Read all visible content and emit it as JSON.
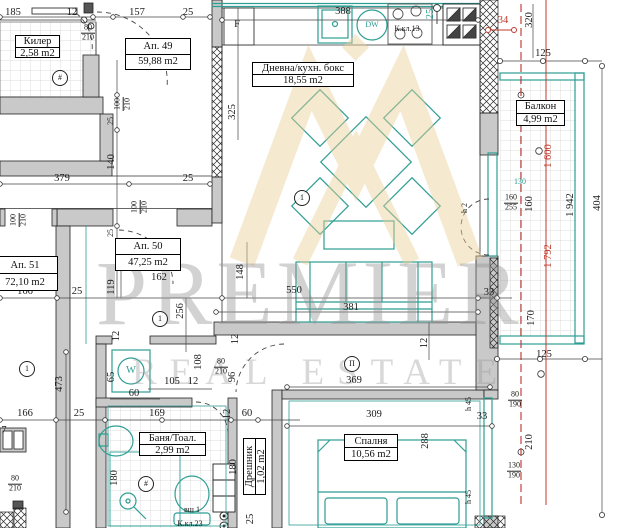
{
  "watermark": {
    "line1": "PREMIER",
    "line2": "REAL ESTATE"
  },
  "colors": {
    "teal": "#2e9e93",
    "red": "#c0392b",
    "wall_gray": "#c9c9c9",
    "watermark_gold": "#e9cf96",
    "watermark_gray": "#949494"
  },
  "rooms": [
    {
      "name": "Килер",
      "area": "2,58 m2",
      "x": 15,
      "y": 35,
      "w": 45,
      "h": 23
    },
    {
      "name": "Ап. 49",
      "area": "59,88 m2",
      "x": 125,
      "y": 38,
      "w": 66,
      "h": 32
    },
    {
      "name": "Дневна/кухн. бокс",
      "area": "18,55 m2",
      "x": 252,
      "y": 62,
      "w": 102,
      "h": 25
    },
    {
      "name": "Ап. 50",
      "area": "47,25 m2",
      "x": 115,
      "y": 238,
      "w": 66,
      "h": 33
    },
    {
      "name": "Ап. 51",
      "area": "72,10 m2",
      "x": -8,
      "y": 256,
      "w": 66,
      "h": 35
    },
    {
      "name": "Балкон",
      "area": "4,99 m2",
      "x": 516,
      "y": 100,
      "w": 49,
      "h": 26
    },
    {
      "name": "Баня/Тоал.",
      "area": "2,99 m2",
      "x": 139,
      "y": 432,
      "w": 67,
      "h": 24
    },
    {
      "name": "Спалня",
      "area": "10,56 m2",
      "x": 344,
      "y": 434,
      "w": 54,
      "h": 27
    },
    {
      "name": "Дрешник",
      "area": "1,02 m2",
      "x": 226,
      "y": 455,
      "w": 57,
      "h": 23,
      "vertical": true
    }
  ],
  "labels": [
    {
      "t": "185",
      "x": 13,
      "y": 13
    },
    {
      "t": "12",
      "x": 72,
      "y": 13
    },
    {
      "t": "157",
      "x": 137,
      "y": 13
    },
    {
      "t": "25",
      "x": 188,
      "y": 13
    },
    {
      "t": "388",
      "x": 343,
      "y": 12
    },
    {
      "t": "25",
      "x": 431,
      "y": 14,
      "v": 1,
      "teal": 1
    },
    {
      "t": "К.кл.13",
      "x": 407,
      "y": 29,
      "small": 1
    },
    {
      "t": "34",
      "x": 503,
      "y": 21,
      "red": 1
    },
    {
      "t": "320",
      "x": 530,
      "y": 20,
      "v": 1
    },
    {
      "t": "125",
      "x": 543,
      "y": 54
    },
    {
      "pair": [
        "80",
        "210"
      ],
      "x": 88,
      "y": 33
    },
    {
      "pair": [
        "100",
        "210"
      ],
      "x": 123,
      "y": 104,
      "v": 1
    },
    {
      "t": "25",
      "x": 111,
      "y": 121,
      "v": 1,
      "small": 1
    },
    {
      "t": "140",
      "x": 112,
      "y": 162,
      "v": 1
    },
    {
      "t": "325",
      "x": 233,
      "y": 112,
      "v": 1
    },
    {
      "t": "379",
      "x": 62,
      "y": 179
    },
    {
      "t": "25",
      "x": 188,
      "y": 179
    },
    {
      "pair": [
        "100",
        "210"
      ],
      "x": 19,
      "y": 220,
      "v": 1
    },
    {
      "pair": [
        "100",
        "210"
      ],
      "x": 140,
      "y": 207,
      "v": 1
    },
    {
      "t": "25",
      "x": 111,
      "y": 233,
      "v": 1,
      "small": 1
    },
    {
      "t": "162",
      "x": 159,
      "y": 278
    },
    {
      "t": "119",
      "x": 112,
      "y": 287,
      "v": 1
    },
    {
      "t": "148",
      "x": 241,
      "y": 272,
      "v": 1
    },
    {
      "t": "256",
      "x": 181,
      "y": 311,
      "v": 1
    },
    {
      "t": "550",
      "x": 294,
      "y": 291
    },
    {
      "t": "381",
      "x": 351,
      "y": 308
    },
    {
      "t": "166",
      "x": 25,
      "y": 292
    },
    {
      "t": "25",
      "x": 77,
      "y": 292
    },
    {
      "t": "33",
      "x": 489,
      "y": 293
    },
    {
      "t": "12",
      "x": 236,
      "y": 339,
      "v": 1
    },
    {
      "t": "12",
      "x": 425,
      "y": 343,
      "v": 1
    },
    {
      "t": "473",
      "x": 60,
      "y": 384,
      "v": 1
    },
    {
      "t": "65",
      "x": 112,
      "y": 377,
      "v": 1
    },
    {
      "t": "60",
      "x": 134,
      "y": 394
    },
    {
      "t": "12",
      "x": 117,
      "y": 336,
      "v": 1
    },
    {
      "t": "105",
      "x": 172,
      "y": 382
    },
    {
      "t": "12",
      "x": 193,
      "y": 382
    },
    {
      "t": "108",
      "x": 199,
      "y": 362,
      "v": 1
    },
    {
      "pair": [
        "80",
        "210"
      ],
      "x": 221,
      "y": 367,
      "small": 1
    },
    {
      "t": "96",
      "x": 233,
      "y": 377,
      "v": 1
    },
    {
      "t": "166",
      "x": 25,
      "y": 414
    },
    {
      "t": "25",
      "x": 79,
      "y": 414
    },
    {
      "t": "169",
      "x": 157,
      "y": 414
    },
    {
      "t": "12",
      "x": 228,
      "y": 414,
      "v": 1
    },
    {
      "t": "60",
      "x": 247,
      "y": 414
    },
    {
      "t": "180",
      "x": 115,
      "y": 478,
      "v": 1
    },
    {
      "t": "180",
      "x": 234,
      "y": 467,
      "v": 1
    },
    {
      "t": "7",
      "x": 4,
      "y": 431
    },
    {
      "pair": [
        "80",
        "210"
      ],
      "x": 15,
      "y": 484,
      "small": 1
    },
    {
      "t": "вш 1",
      "x": 192,
      "y": 510,
      "small": 1
    },
    {
      "t": "К.кл.23",
      "x": 190,
      "y": 524,
      "small": 1
    },
    {
      "t": "25",
      "x": 251,
      "y": 519,
      "v": 1
    },
    {
      "t": "369",
      "x": 354,
      "y": 381
    },
    {
      "t": "309",
      "x": 374,
      "y": 415
    },
    {
      "t": "288",
      "x": 426,
      "y": 441,
      "v": 1
    },
    {
      "t": "h 45",
      "x": 469,
      "y": 404,
      "v": 1,
      "small": 1
    },
    {
      "t": "h 45",
      "x": 469,
      "y": 497,
      "v": 1,
      "small": 1
    },
    {
      "t": "33",
      "x": 482,
      "y": 417
    },
    {
      "pair": [
        "80",
        "190"
      ],
      "x": 515,
      "y": 400,
      "small": 1
    },
    {
      "pair": [
        "130",
        "190"
      ],
      "x": 514,
      "y": 471,
      "small": 1
    },
    {
      "t": "210",
      "x": 530,
      "y": 442,
      "v": 1
    },
    {
      "t": "125",
      "x": 544,
      "y": 355
    },
    {
      "t": "170",
      "x": 532,
      "y": 318,
      "v": 1
    },
    {
      "t": "130",
      "x": 520,
      "y": 182,
      "teal": 1,
      "small": 1
    },
    {
      "pair": [
        "160",
        "255"
      ],
      "x": 511,
      "y": 203,
      "small": 1
    },
    {
      "t": "160",
      "x": 530,
      "y": 204,
      "v": 1
    },
    {
      "t": "h 2",
      "x": 465,
      "y": 208,
      "v": 1,
      "small": 1
    },
    {
      "t": "1 942",
      "x": 571,
      "y": 205,
      "v": 1
    },
    {
      "t": "404",
      "x": 598,
      "y": 203,
      "v": 1
    },
    {
      "t": "1 600",
      "x": 549,
      "y": 156,
      "v": 1,
      "red": 1
    },
    {
      "t": "1 792",
      "x": 549,
      "y": 256,
      "v": 1,
      "red": 1
    },
    {
      "t": "F",
      "x": 237,
      "y": 25
    },
    {
      "t": "DW",
      "x": 372,
      "y": 25,
      "teal": 1,
      "small": 1
    },
    {
      "t": "W",
      "x": 131,
      "y": 371,
      "teal": 1
    },
    {
      "t": "1",
      "x": 302,
      "y": 198,
      "circled": 1
    },
    {
      "t": "1",
      "x": 160,
      "y": 319,
      "circled": 1
    },
    {
      "t": "1",
      "x": 27,
      "y": 369,
      "circled": 1
    },
    {
      "t": "П",
      "x": 352,
      "y": 364,
      "circled": 1
    },
    {
      "t": "#",
      "x": 60,
      "y": 78,
      "circled": 1
    },
    {
      "t": "#",
      "x": 146,
      "y": 484,
      "circled": 1
    }
  ]
}
